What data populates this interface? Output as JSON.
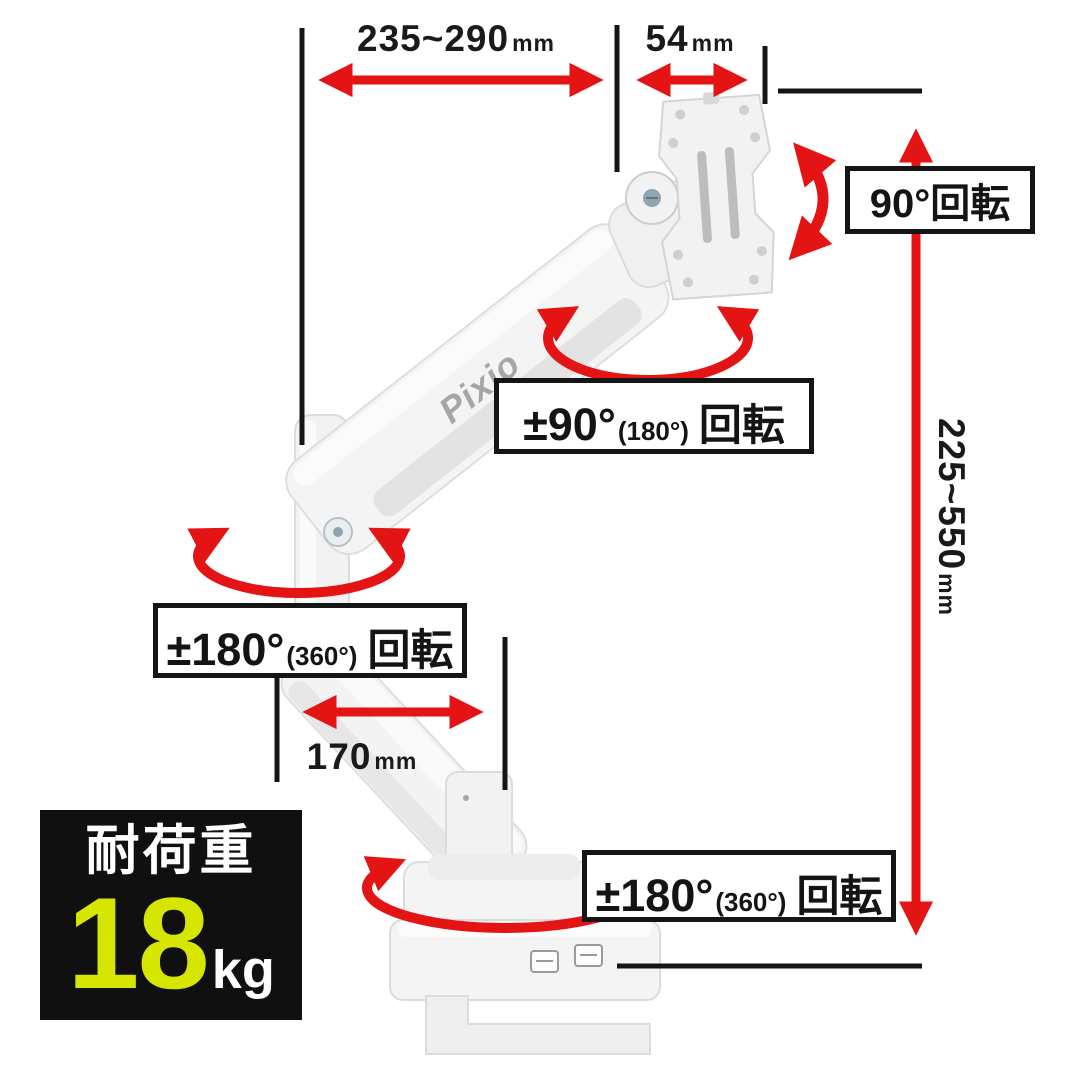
{
  "product": {
    "brand": "Pixio",
    "type": "monitor-arm-spec-diagram"
  },
  "dims": {
    "reach": {
      "value": "235~290",
      "unit": "mm"
    },
    "vesa": {
      "value": "54",
      "unit": "mm"
    },
    "height": {
      "value": "225~550",
      "unit": "mm"
    },
    "offset": {
      "value": "170",
      "unit": "mm"
    }
  },
  "labels": {
    "head_rotation": "90°回転",
    "elbow": {
      "main": "±90°",
      "paren": "(180°)",
      "suffix": "回転"
    },
    "shoulder": {
      "main": "±180°",
      "paren": "(360°)",
      "suffix": "回転"
    },
    "base": {
      "main": "±180°",
      "paren": "(360°)",
      "suffix": "回転"
    }
  },
  "load_badge": {
    "title": "耐荷重",
    "value": "18",
    "unit": "kg"
  },
  "colors": {
    "arrow_red": "#e51414",
    "line_black": "#151515",
    "badge_bg": "#101010",
    "badge_value": "#d7e600",
    "arm_white": "#f4f4f4",
    "logo_gray": "#a6a6a6"
  }
}
